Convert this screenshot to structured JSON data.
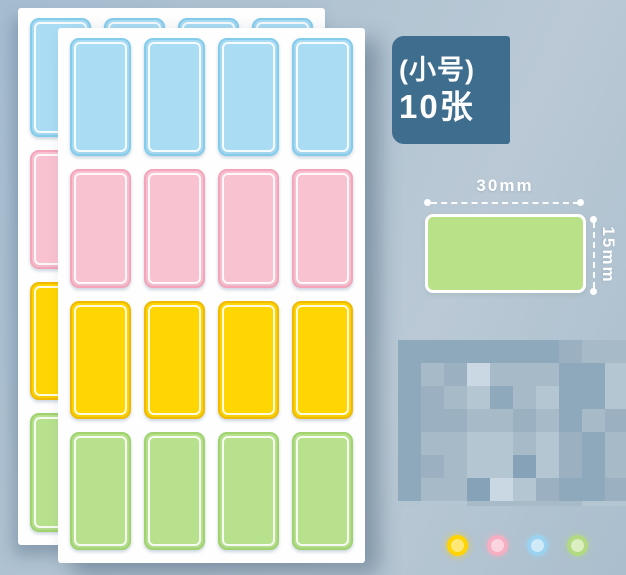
{
  "badge": {
    "size_label": "(小号)",
    "count_label": "10张",
    "bg": "#3f6d8e"
  },
  "size_diagram": {
    "width_label": "30mm",
    "height_label": "15mm",
    "swatch_color": "#b9e288"
  },
  "sheets": {
    "count": 2,
    "columns": 4,
    "rows": [
      {
        "name": "blue",
        "fill": "#aadcf4",
        "border": "#84ccec"
      },
      {
        "name": "pink",
        "fill": "#f9c2d0",
        "border": "#f4a5ba"
      },
      {
        "name": "yellow",
        "fill": "#ffd502",
        "border": "#f0ba02"
      },
      {
        "name": "green",
        "fill": "#b7e18d",
        "border": "#a0d26e"
      }
    ]
  },
  "watermark": {
    "palette": [
      "#8fa9bc",
      "#9bb1c2",
      "#a6bac8",
      "#b3c6d2",
      "#c9d8e2",
      "#86a2b8"
    ],
    "grid": [
      "0000000122",
      "0214222003",
      "0123023003",
      "0112212021",
      "0223323102",
      "0123353102",
      "0225431001",
      "3332222233"
    ]
  },
  "color_dots": [
    {
      "name": "yellow",
      "ring": "#ffd400",
      "fill": "#ffe876"
    },
    {
      "name": "pink",
      "ring": "#f6aec2",
      "fill": "#fad4de"
    },
    {
      "name": "blue",
      "ring": "#9bd2ef",
      "fill": "#d0eaf8"
    },
    {
      "name": "green",
      "ring": "#b2da81",
      "fill": "#dcefc2"
    }
  ]
}
